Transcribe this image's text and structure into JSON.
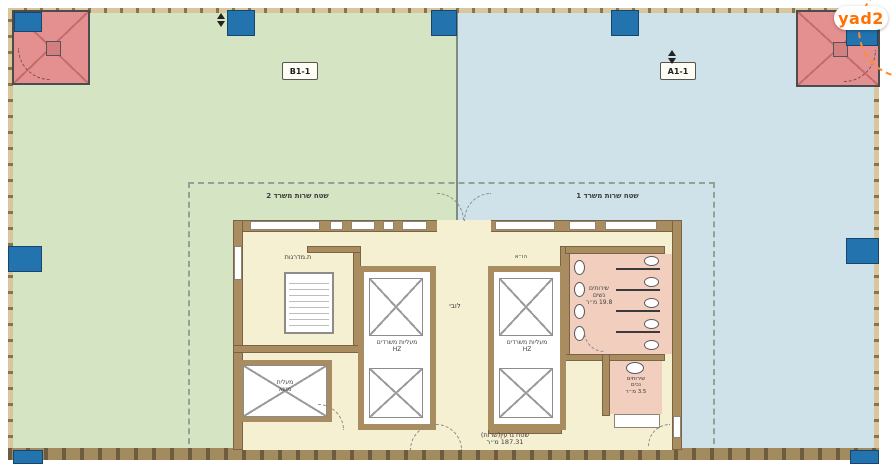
{
  "logo": {
    "text": "yad2",
    "color": "#ff7100"
  },
  "units": {
    "b": {
      "label": "B1-1",
      "fill": "#d5e4c3"
    },
    "a": {
      "label": "A1-1",
      "fill": "#cfe2ea"
    }
  },
  "service_areas": {
    "office2": "שטח שרות משרד 2",
    "office1": "שטח שרות משרד 1"
  },
  "core": {
    "stairwell": "ת.מדרגות",
    "office_elevators_line1": "מעליות משרדים",
    "office_elevators_line2": "HZ",
    "freight_elevator_line1": "מעלית",
    "freight_elevator_line2": "משא",
    "wc_women_line1": "שירותים",
    "wc_women_line2": "נשים",
    "wc_women_area": "19.8 מ״ר",
    "wc_accessible_line1": "שירותים",
    "wc_accessible_line2": "נכים",
    "wc_accessible_area": "3.5 מ״ר",
    "lobby": "לובי",
    "hvac": "הו״א",
    "core_area_line1": "שטח גרעין(שרות)",
    "core_area_line2": "187.31 מ״ר"
  },
  "colors": {
    "unit_b_green": "#d5e4c3",
    "unit_a_blue": "#cfe2ea",
    "stair_red": "#e59090",
    "column_blue": "#2273ae",
    "core_beige": "#f6f0d3",
    "wall_brown": "#a98c5f",
    "wc_pink": "#f1cebe",
    "brand_orange": "#ff7100"
  }
}
